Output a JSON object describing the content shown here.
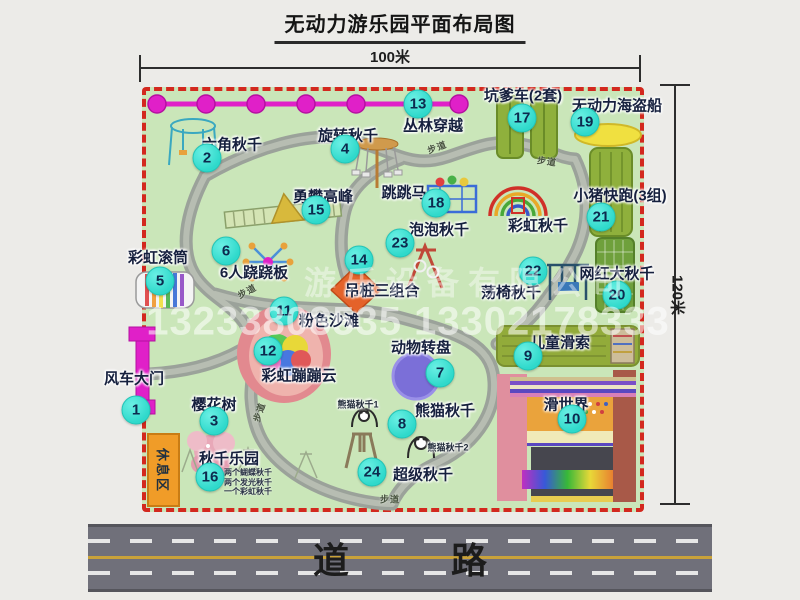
{
  "title": "无动力游乐园平面布局图",
  "dimensions": {
    "width_label": "100米",
    "height_label": "120米"
  },
  "road": {
    "label": "道 路"
  },
  "rest_area": {
    "label": "休息区"
  },
  "watermark": {
    "company": "游乐设备有限公司",
    "phone": "13233808535 13302178333"
  },
  "trail_label_text": "步道",
  "trail_labels": [
    {
      "x": 437,
      "y": 147,
      "rot": -20
    },
    {
      "x": 547,
      "y": 161,
      "rot": 8
    },
    {
      "x": 247,
      "y": 291,
      "rot": -28
    },
    {
      "x": 259,
      "y": 412,
      "rot": -72
    },
    {
      "x": 390,
      "y": 499,
      "rot": 0
    }
  ],
  "colors": {
    "park_green": "#cae6b9",
    "boundary_red": "#d3281e",
    "badge_cyan": "#2fd9cb",
    "trail_gray": "#9ba29a",
    "chain_magenta": "#e020c8",
    "road_gray": "#70707a",
    "rest_orange": "#f09c28"
  },
  "attractions": [
    {
      "num": "1",
      "name": "风车大门",
      "badge": {
        "x": 136,
        "y": 410
      },
      "label": {
        "x": 134,
        "y": 378
      }
    },
    {
      "num": "2",
      "name": "六角秋千",
      "badge": {
        "x": 207,
        "y": 158
      },
      "label": {
        "x": 232,
        "y": 144
      }
    },
    {
      "num": "3",
      "name": "樱花树",
      "badge": {
        "x": 214,
        "y": 421
      },
      "label": {
        "x": 214,
        "y": 404
      }
    },
    {
      "num": "4",
      "name": "旋转秋千",
      "badge": {
        "x": 345,
        "y": 149
      },
      "label": {
        "x": 348,
        "y": 135
      }
    },
    {
      "num": "5",
      "name": "彩虹滚筒",
      "badge": {
        "x": 160,
        "y": 281
      },
      "label": {
        "x": 158,
        "y": 257
      }
    },
    {
      "num": "6",
      "name": "6人跷跷板",
      "badge": {
        "x": 226,
        "y": 251
      },
      "label": {
        "x": 254,
        "y": 272
      }
    },
    {
      "num": "7",
      "name": "动物转盘",
      "badge": {
        "x": 440,
        "y": 373
      },
      "label": {
        "x": 421,
        "y": 347
      }
    },
    {
      "num": "8",
      "name": "熊猫秋千",
      "badge": {
        "x": 402,
        "y": 424
      },
      "label": {
        "x": 445,
        "y": 410
      }
    },
    {
      "num": "9",
      "name": "儿童滑索",
      "badge": {
        "x": 528,
        "y": 356
      },
      "label": {
        "x": 560,
        "y": 342
      }
    },
    {
      "num": "10",
      "name": "滑世界",
      "badge": {
        "x": 572,
        "y": 419
      },
      "label": {
        "x": 566,
        "y": 404
      }
    },
    {
      "num": "11",
      "name": "粉色沙滩",
      "badge": {
        "x": 284,
        "y": 311
      },
      "label": {
        "x": 329,
        "y": 320
      }
    },
    {
      "num": "12",
      "name": "彩虹蹦蹦云",
      "badge": {
        "x": 268,
        "y": 351
      },
      "label": {
        "x": 299,
        "y": 375
      }
    },
    {
      "num": "13",
      "name": "丛林穿越",
      "badge": {
        "x": 418,
        "y": 104
      },
      "label": {
        "x": 433,
        "y": 125
      }
    },
    {
      "num": "14",
      "name": "吊桩三组合",
      "badge": {
        "x": 359,
        "y": 260
      },
      "label": {
        "x": 382,
        "y": 290
      }
    },
    {
      "num": "15",
      "name": "勇攀高峰",
      "badge": {
        "x": 316,
        "y": 210
      },
      "label": {
        "x": 323,
        "y": 196
      }
    },
    {
      "num": "16",
      "name": "秋千乐园",
      "badge": {
        "x": 210,
        "y": 477
      },
      "label": {
        "x": 229,
        "y": 458
      },
      "sub": [
        "两个蝴蝶秋千",
        "两个发光秋千",
        "一个彩虹秋千"
      ],
      "sub_pos": {
        "x": 224,
        "y": 482
      }
    },
    {
      "num": "17",
      "name": "坑爹车(2套)",
      "badge": {
        "x": 522,
        "y": 118
      },
      "label": {
        "x": 523,
        "y": 95
      }
    },
    {
      "num": "18",
      "name": "跳跳马",
      "badge": {
        "x": 436,
        "y": 203
      },
      "label": {
        "x": 404,
        "y": 192
      }
    },
    {
      "num": "19",
      "name": "无动力海盗船",
      "badge": {
        "x": 585,
        "y": 122
      },
      "label": {
        "x": 617,
        "y": 105
      }
    },
    {
      "num": "20",
      "name": "网红大秋千",
      "badge": {
        "x": 617,
        "y": 295
      },
      "label": {
        "x": 617,
        "y": 273
      }
    },
    {
      "num": "21",
      "name": "小猪快跑(3组)",
      "badge": {
        "x": 601,
        "y": 217
      },
      "label": {
        "x": 620,
        "y": 195
      }
    },
    {
      "num": "22",
      "name": "荡椅秋千",
      "badge": {
        "x": 533,
        "y": 271
      },
      "label": {
        "x": 511,
        "y": 292
      }
    },
    {
      "num": "23",
      "name": "泡泡秋千",
      "badge": {
        "x": 400,
        "y": 243
      },
      "label": {
        "x": 439,
        "y": 229
      }
    },
    {
      "num": "24",
      "name": "超级秋千",
      "badge": {
        "x": 372,
        "y": 472
      },
      "label": {
        "x": 423,
        "y": 474
      }
    },
    {
      "num": null,
      "name": "彩虹秋千",
      "badge": null,
      "label": {
        "x": 538,
        "y": 225
      }
    },
    {
      "num": null,
      "name": "熊猫秋千1",
      "badge": null,
      "label": {
        "x": 358,
        "y": 404
      },
      "size": "xs"
    },
    {
      "num": null,
      "name": "熊猫秋千2",
      "badge": null,
      "label": {
        "x": 448,
        "y": 447
      },
      "size": "xs"
    }
  ]
}
